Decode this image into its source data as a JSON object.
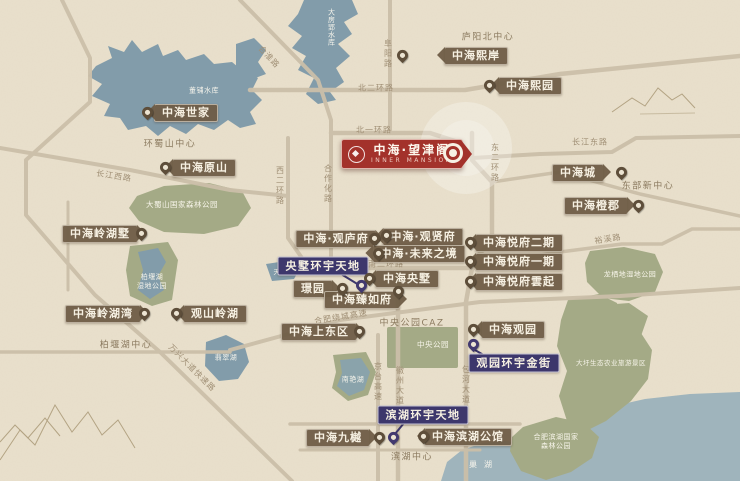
{
  "map": {
    "main_project": {
      "name": "中海·望津阁",
      "subtitle": "INNER MANSION"
    },
    "colors": {
      "background": "#e9e0cc",
      "water": "#829caa",
      "water_big_lake": "#9fb4bc",
      "park_green": "#a4aa86",
      "road": "#cbbfa9",
      "tag_brown": "#6d5b45",
      "tag_purple": "#3d376c",
      "accent_red": "#a3322b",
      "pin_brown": "#5e4e3a",
      "road_text": "#a08f75"
    },
    "markers": [
      {
        "label": "中海世家",
        "color": "brown",
        "dir": "left",
        "cx": 186,
        "cy": 113,
        "px": 147,
        "py": 120
      },
      {
        "label": "中海原山",
        "color": "brown",
        "dir": "left",
        "cx": 204,
        "cy": 168,
        "px": 165,
        "py": 175
      },
      {
        "label": "中海熙岸",
        "color": "brown",
        "dir": "left",
        "cx": 476,
        "cy": 56,
        "px": 402,
        "py": 63
      },
      {
        "label": "中海熙园",
        "color": "brown",
        "dir": "left",
        "cx": 530,
        "cy": 86,
        "px": 489,
        "py": 93
      },
      {
        "label": "中海城",
        "color": "brown",
        "dir": "right",
        "cx": 578,
        "cy": 173,
        "px": 621,
        "py": 180
      },
      {
        "label": "中海橙郡",
        "color": "brown",
        "dir": "right",
        "cx": 596,
        "cy": 206,
        "px": 638,
        "py": 213
      },
      {
        "label": "中海悦府二期",
        "color": "brown",
        "dir": "left",
        "cx": 519,
        "cy": 243,
        "px": 470,
        "py": 250
      },
      {
        "label": "中海悦府一期",
        "color": "brown",
        "dir": "left",
        "cx": 519,
        "cy": 262,
        "px": 470,
        "py": 269
      },
      {
        "label": "中海悦府雲起",
        "color": "brown",
        "dir": "left",
        "cx": 519,
        "cy": 282,
        "px": 470,
        "py": 289
      },
      {
        "label": "中海·观庐府",
        "color": "brown",
        "dir": "right",
        "cx": 336,
        "cy": 239,
        "px": 374,
        "py": 246
      },
      {
        "label": "中海·观贤府",
        "color": "brown",
        "dir": "left",
        "cx": 423,
        "cy": 237,
        "px": 386,
        "py": 243
      },
      {
        "label": "中海·未来之境",
        "color": "brown",
        "dir": "left",
        "cx": 419,
        "cy": 254,
        "px": 378,
        "py": 261
      },
      {
        "label": "中海央墅",
        "color": "brown",
        "dir": "left",
        "cx": 407,
        "cy": 279,
        "px": 369,
        "py": 286
      },
      {
        "label": "璟园",
        "color": "brown",
        "dir": "right",
        "cx": 313,
        "cy": 289,
        "px": 342,
        "py": 296
      },
      {
        "label": "中海臻如府",
        "color": "brown",
        "dir": "right",
        "cx": 362,
        "cy": 300,
        "px": 398,
        "py": 299
      },
      {
        "label": "中海上东区",
        "color": "brown",
        "dir": "right",
        "cx": 319,
        "cy": 332,
        "px": 359,
        "py": 339
      },
      {
        "label": "中海岭湖墅",
        "color": "brown",
        "dir": "right",
        "cx": 100,
        "cy": 234,
        "px": 141,
        "py": 241
      },
      {
        "label": "中海岭湖湾",
        "color": "brown",
        "dir": "right",
        "cx": 103,
        "cy": 314,
        "px": 144,
        "py": 321
      },
      {
        "label": "观山岭湖",
        "color": "brown",
        "dir": "left",
        "cx": 215,
        "cy": 314,
        "px": 176,
        "py": 321
      },
      {
        "label": "中海观园",
        "color": "brown",
        "dir": "left",
        "cx": 513,
        "cy": 330,
        "px": 473,
        "py": 337
      },
      {
        "label": "中海九樾",
        "color": "brown",
        "dir": "right",
        "cx": 338,
        "cy": 438,
        "px": 379,
        "py": 445
      },
      {
        "label": "中海滨湖公馆",
        "color": "brown",
        "dir": "left",
        "cx": 468,
        "cy": 437,
        "px": 423,
        "py": 444
      },
      {
        "label": "央墅环宇天地",
        "color": "purple",
        "dir": "none",
        "cx": 323,
        "cy": 266,
        "px": 361,
        "py": 293
      },
      {
        "label": "观园环宇金街",
        "color": "purple",
        "dir": "none",
        "cx": 514,
        "cy": 363,
        "px": 473,
        "py": 352
      },
      {
        "label": "滨湖环宇天地",
        "color": "purple",
        "dir": "none",
        "cx": 423,
        "cy": 415,
        "px": 393,
        "py": 445
      }
    ],
    "road_labels": [
      {
        "text": "北二环路",
        "x": 376,
        "y": 88,
        "rot": 0
      },
      {
        "text": "北一环路",
        "x": 374,
        "y": 130,
        "rot": 0
      },
      {
        "text": "阜阳路",
        "x": 388,
        "y": 54,
        "vert": true
      },
      {
        "text": "合淮路",
        "x": 269,
        "y": 57,
        "rot": 47
      },
      {
        "text": "东二环路",
        "x": 495,
        "y": 163,
        "vert": true
      },
      {
        "text": "西二环路",
        "x": 280,
        "y": 186,
        "vert": true
      },
      {
        "text": "合作化路",
        "x": 328,
        "y": 184,
        "vert": true
      },
      {
        "text": "长江西路",
        "x": 114,
        "y": 176,
        "rot": 9
      },
      {
        "text": "长江东路",
        "x": 590,
        "y": 142,
        "rot": 0
      },
      {
        "text": "南二环路",
        "x": 386,
        "y": 264,
        "rot": 0
      },
      {
        "text": "裕溪路",
        "x": 608,
        "y": 239,
        "rot": -9
      },
      {
        "text": "合肥绕城高速",
        "x": 341,
        "y": 317,
        "rot": -9
      },
      {
        "text": "万兴大道快速路",
        "x": 192,
        "y": 368,
        "rot": 45
      },
      {
        "text": "京台高速",
        "x": 378,
        "y": 382,
        "vert": true
      },
      {
        "text": "徽州大道",
        "x": 400,
        "y": 386,
        "vert": true
      },
      {
        "text": "包河大道",
        "x": 466,
        "y": 385,
        "vert": true
      }
    ],
    "district_labels": [
      {
        "text": "庐阳北中心",
        "x": 488,
        "y": 36
      },
      {
        "text": "东部新中心",
        "x": 648,
        "y": 185
      },
      {
        "text": "环蜀山中心",
        "x": 170,
        "y": 143
      },
      {
        "text": "柏堰湖中心",
        "x": 126,
        "y": 344
      },
      {
        "text": "滨湖中心",
        "x": 412,
        "y": 456
      },
      {
        "text": "中央公园CAZ",
        "x": 412,
        "y": 322
      }
    ],
    "area_labels": [
      {
        "text": "董铺水库",
        "x": 204,
        "y": 91,
        "size": 7
      },
      {
        "text": "大房郢水库",
        "x": 331,
        "y": 27,
        "vert": true,
        "size": 7
      },
      {
        "text": "天鹅湖",
        "x": 284,
        "y": 272,
        "size": 6.5
      },
      {
        "text": "柏堰湖\n湿地公园",
        "x": 152,
        "y": 282,
        "size": 7
      },
      {
        "text": "翡翠湖",
        "x": 226,
        "y": 358,
        "size": 7
      },
      {
        "text": "南艳湖",
        "x": 353,
        "y": 380,
        "size": 7
      },
      {
        "text": "巢湖",
        "x": 484,
        "y": 465,
        "size": 8,
        "ls": 7
      },
      {
        "text": "大蜀山国家森林公园",
        "x": 182,
        "y": 205,
        "size": 7.5
      },
      {
        "text": "中央公园",
        "x": 433,
        "y": 345,
        "size": 7.5
      },
      {
        "text": "龙栖地湿地公园",
        "x": 630,
        "y": 275,
        "size": 7
      },
      {
        "text": "大圩生态农业旅游景区",
        "x": 611,
        "y": 363,
        "size": 6.5
      },
      {
        "text": "合肥滨湖国家\n森林公园",
        "x": 556,
        "y": 442,
        "size": 7
      }
    ]
  }
}
